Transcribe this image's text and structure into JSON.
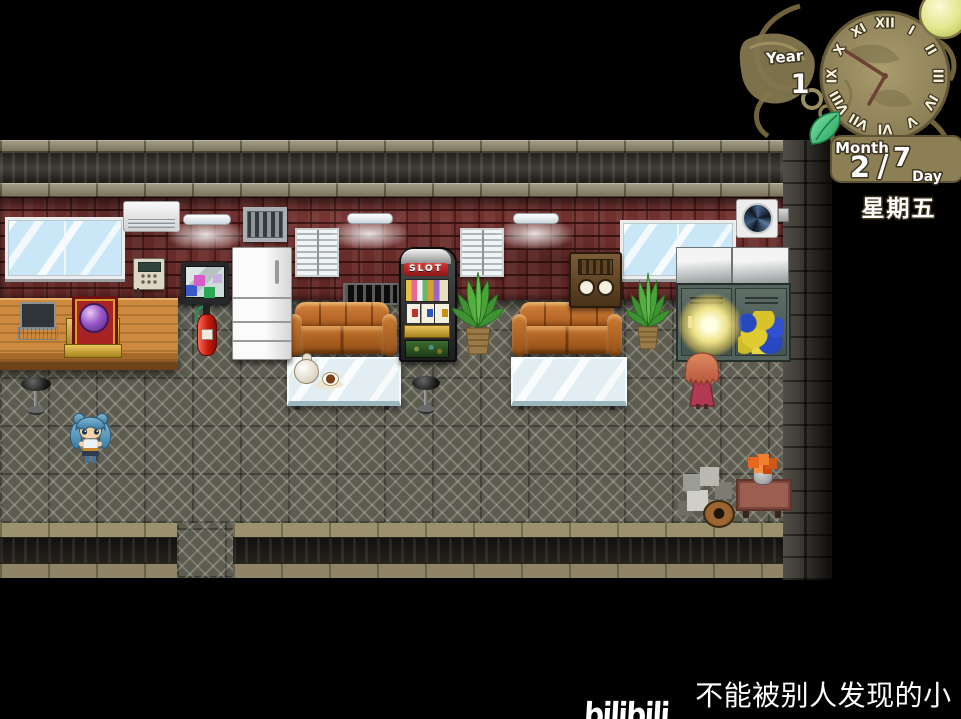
{
  "hud": {
    "calendar": {
      "year_label": "Year",
      "year_value": "1",
      "month_label": "Month",
      "month_value": "2",
      "separator": "/",
      "day_value": "7",
      "day_label": "Day",
      "weekday": "星期五"
    },
    "clock": {
      "numerals": [
        "XII",
        "I",
        "II",
        "III",
        "IV",
        "V",
        "VI",
        "VII",
        "VIII",
        "IX",
        "X",
        "XI"
      ]
    },
    "colors": {
      "panel_gold": "#8d7f55",
      "leaf_green": "#2fae62",
      "text_white": "#ffffff"
    }
  },
  "scene": {
    "slot_machine_label": "SLOT",
    "objects": [
      "window",
      "air-conditioner",
      "fluorescent-light",
      "wall-vent",
      "blinds",
      "exhaust-fan",
      "wall-phone",
      "tv",
      "refrigerator",
      "desk",
      "laptop",
      "crystal-ball-shrine",
      "fire-extinguisher",
      "sofa",
      "glass-table",
      "teapot",
      "coffee-cup",
      "bar-stool",
      "slot-machine",
      "potted-plant",
      "antique-radio",
      "lockers",
      "locker-graffiti",
      "glowing-locker",
      "junk-pile",
      "flower-table",
      "blue-haired-girl",
      "orange-haired-person"
    ]
  },
  "watermark": {
    "logo": "bilibili",
    "text": "不能被别人发现的小号"
  }
}
